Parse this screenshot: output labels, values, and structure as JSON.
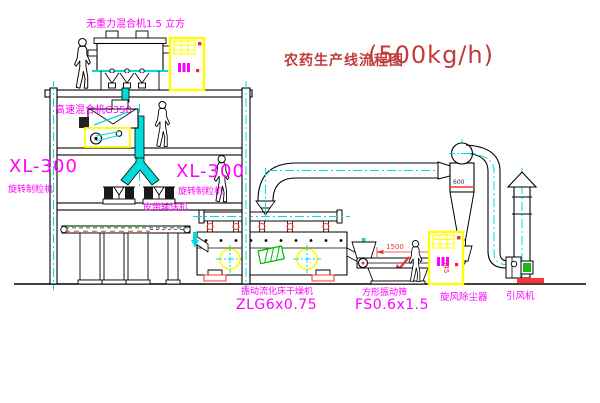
{
  "title": {
    "name": "农药生产线流程图",
    "capacity": "(500kg/h)"
  },
  "labels": {
    "gravity_free_mixer": "无重力混合机1.5 立方",
    "high_speed_mixer": "高速混合机G350",
    "granulator_left_model": "XL-300",
    "granulator_left_name": "旋转制粒机",
    "granulator_right_model": "XL-300",
    "granulator_right_name": "旋转制粒机",
    "belt_conveyor": "皮带输送机",
    "fluid_bed_dryer_name": "振动流化床干燥机",
    "fluid_bed_dryer_model": "ZLG6x0.75",
    "vibrating_screen_name": "方形振动筛",
    "vibrating_screen_model": "FS0.6x1.5",
    "cyclone_dust_collector": "旋风除尘器",
    "induced_draft_fan": "引风机"
  },
  "dimensions": {
    "screen_length": "1500",
    "screen_height": "345",
    "cyclone_diameter": "600"
  },
  "colors": {
    "label_magenta": "#ff00ff",
    "title_red": "#c23b3b",
    "centerline_cyan": "#00dcdc",
    "dimension_red": "#e83030",
    "cabinet_yellow": "#ffff00",
    "conveyor_green": "#00b400",
    "line_black": "#000000"
  }
}
